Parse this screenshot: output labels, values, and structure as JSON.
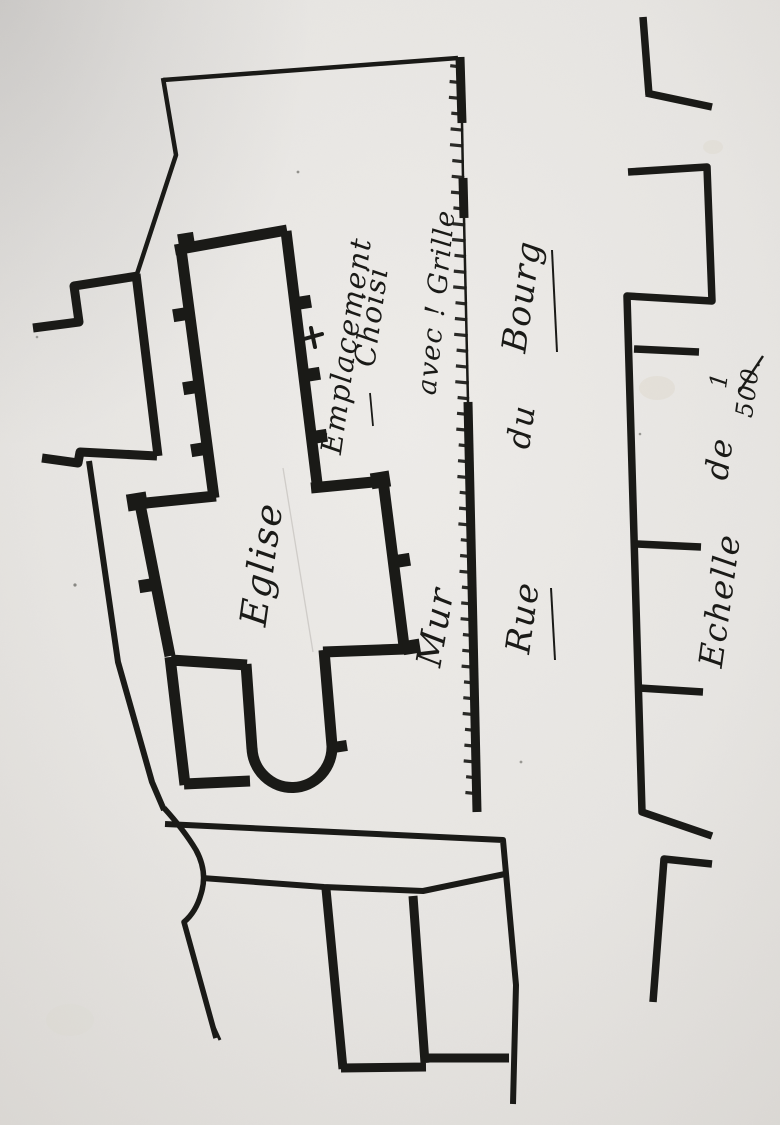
{
  "plan": {
    "site_marker": {
      "symbol": "+",
      "label_line1": "Emplacement",
      "label_line2": "Choisi"
    },
    "church_label": "Eglise",
    "wall_labels": {
      "mur": "Mur",
      "avec_grille": "avec ! Grille"
    },
    "street_name": {
      "rue": "Rue",
      "du": "du",
      "bourg": "Bourg"
    },
    "scale": {
      "echelle": "Echelle",
      "de": "de",
      "numerator": "1",
      "denominator": "500."
    }
  },
  "colors": {
    "paper": "#e7e5e2",
    "ink": "#1a1a17"
  }
}
